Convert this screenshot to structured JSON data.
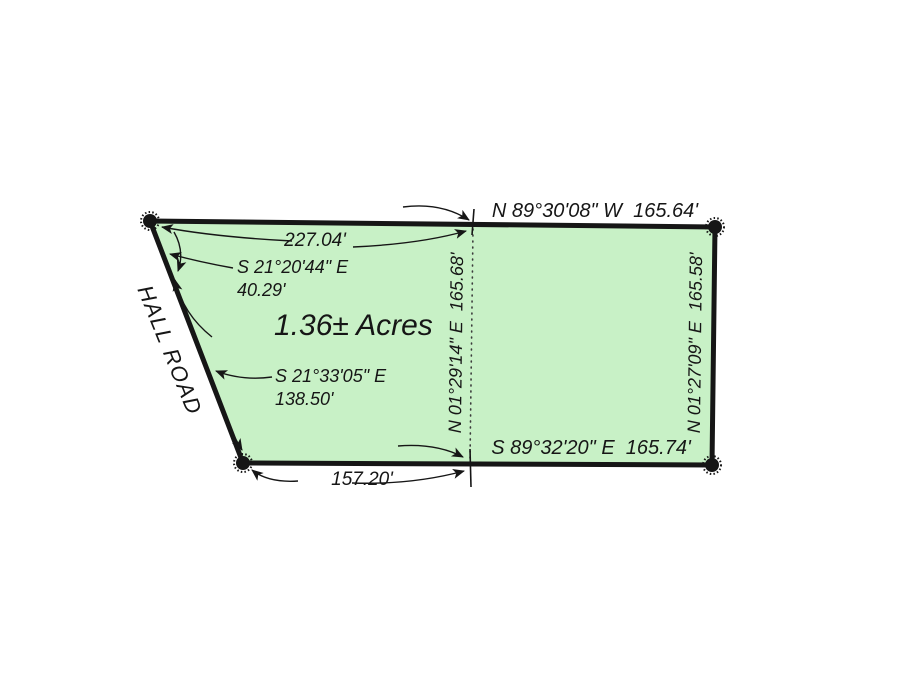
{
  "drawing": {
    "background_color": "#ffffff",
    "parcel_fill": "#c8f1c6",
    "line_color": "#161616",
    "area_label": "1.36± Acres",
    "road_label": "HALL ROAD"
  },
  "boundaries": {
    "north_line": {
      "bearing_distance": "N 89°30'08\" W  165.64'"
    },
    "north_left_distance": "227.04'",
    "west_upper": {
      "bearing": "S 21°20'44\" E",
      "distance": "40.29'"
    },
    "west_lower": {
      "bearing": "S 21°33'05\" E",
      "distance": "138.50'"
    },
    "center_division": {
      "bearing_distance": "N 01°29'14\" E  165.68'"
    },
    "east_line": {
      "bearing_distance": "N 01°27'09\" E  165.58'"
    },
    "south_line": {
      "bearing_distance": "S 89°32'20\" E  165.74'"
    },
    "south_left_distance": "157.20'"
  }
}
